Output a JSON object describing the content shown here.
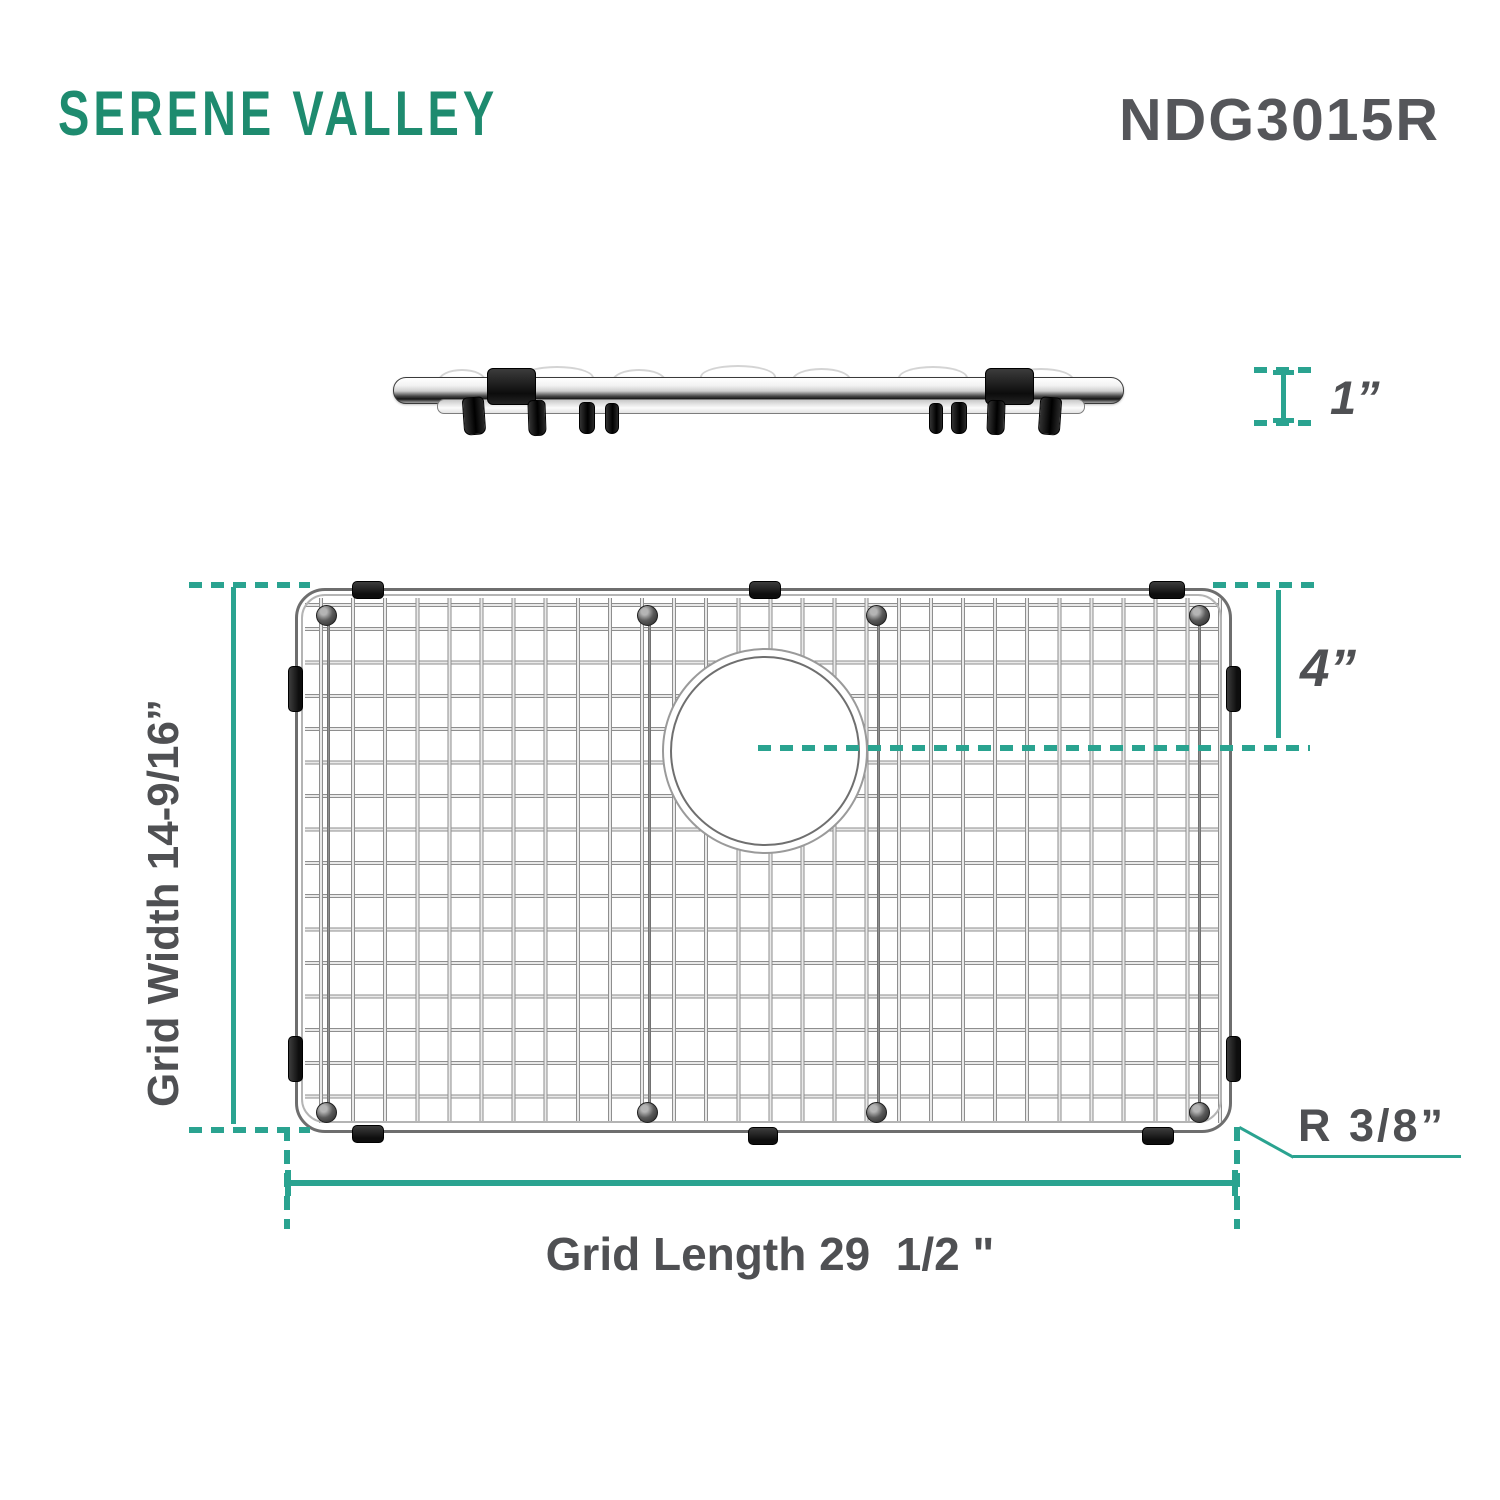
{
  "brand": {
    "name": "SERENE VALLEY"
  },
  "model": "NDG3015R",
  "dims": {
    "side_height": "1”",
    "hole_offset": "4”",
    "width_label": "Grid Width 14-9/16”",
    "length_label": "Grid Length 29  1/2 \"",
    "corner_radius": "R 3/8”"
  },
  "colors": {
    "accent": "#2AA390",
    "brand": "#1E8B6F",
    "text": "#4F5053",
    "model_text": "#55565A"
  }
}
